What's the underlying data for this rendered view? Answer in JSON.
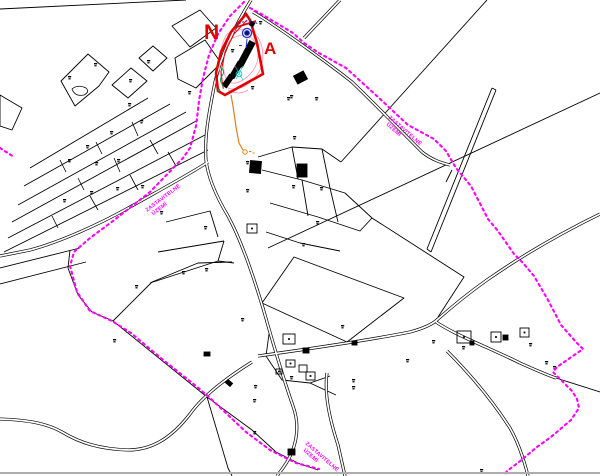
{
  "map": {
    "north_label": "N",
    "area_label": "A",
    "boundary_label": {
      "line1": "ZASTAVITELNÉ",
      "line2": "ÚZEMÍ"
    },
    "colors": {
      "boundary": "#ff00ff",
      "site": "#e30000",
      "contour": "#ff8fb0",
      "utility": "#e07f1a",
      "water": "#2136c9",
      "line": "#000000",
      "frame": "#adadad"
    },
    "parcel_marks": [
      [
        68,
        76
      ],
      [
        94,
        63
      ],
      [
        129,
        79
      ],
      [
        147,
        60
      ],
      [
        188,
        91
      ],
      [
        128,
        103
      ],
      [
        140,
        120
      ],
      [
        110,
        131
      ],
      [
        86,
        145
      ],
      [
        117,
        159
      ],
      [
        95,
        162
      ],
      [
        68,
        159
      ],
      [
        141,
        185
      ],
      [
        116,
        187
      ],
      [
        90,
        191
      ],
      [
        63,
        199
      ],
      [
        160,
        211
      ],
      [
        135,
        285
      ],
      [
        182,
        271
      ],
      [
        205,
        268
      ],
      [
        246,
        189
      ],
      [
        292,
        185
      ],
      [
        293,
        136
      ],
      [
        290,
        95
      ],
      [
        320,
        187
      ],
      [
        246,
        161
      ],
      [
        204,
        226
      ],
      [
        241,
        318
      ],
      [
        254,
        385
      ],
      [
        290,
        376
      ],
      [
        352,
        386
      ],
      [
        406,
        359
      ],
      [
        480,
        469
      ],
      [
        341,
        325
      ],
      [
        545,
        361
      ],
      [
        253,
        431
      ],
      [
        432,
        340
      ],
      [
        462,
        346
      ],
      [
        529,
        343
      ],
      [
        553,
        366
      ],
      [
        113,
        339
      ],
      [
        253,
        399
      ],
      [
        352,
        379
      ],
      [
        302,
        243
      ],
      [
        316,
        221
      ],
      [
        259,
        21
      ],
      [
        287,
        97
      ],
      [
        315,
        97
      ],
      [
        251,
        86
      ],
      [
        231,
        49
      ]
    ],
    "buildings": [
      {
        "x": 283,
        "y": 334,
        "w": 12,
        "h": 10,
        "filled": false,
        "dot": true,
        "angle": 0
      },
      {
        "x": 303,
        "y": 348,
        "w": 6,
        "h": 5,
        "filled": true,
        "dot": false,
        "angle": 0
      },
      {
        "x": 286,
        "y": 360,
        "w": 9,
        "h": 7,
        "filled": false,
        "dot": true,
        "angle": 0
      },
      {
        "x": 299,
        "y": 365,
        "w": 8,
        "h": 7,
        "filled": false,
        "dot": false,
        "angle": 0
      },
      {
        "x": 276,
        "y": 369,
        "w": 6,
        "h": 5,
        "filled": false,
        "dot": true,
        "angle": 0
      },
      {
        "x": 306,
        "y": 372,
        "w": 9,
        "h": 8,
        "filled": false,
        "dot": true,
        "angle": 0
      },
      {
        "x": 457,
        "y": 331,
        "w": 14,
        "h": 12,
        "filled": false,
        "dot": true,
        "angle": 0
      },
      {
        "x": 491,
        "y": 332,
        "w": 10,
        "h": 10,
        "filled": false,
        "dot": true,
        "angle": 0
      },
      {
        "x": 503,
        "y": 335,
        "w": 5,
        "h": 5,
        "filled": true,
        "dot": false,
        "angle": 0
      },
      {
        "x": 520,
        "y": 328,
        "w": 9,
        "h": 9,
        "filled": false,
        "dot": true,
        "angle": 0
      },
      {
        "x": 470,
        "y": 341,
        "w": 4,
        "h": 4,
        "filled": true,
        "dot": false,
        "angle": 0
      },
      {
        "x": 204,
        "y": 352,
        "w": 6,
        "h": 4,
        "filled": true,
        "dot": false,
        "angle": 0
      },
      {
        "x": 226,
        "y": 381,
        "w": 6,
        "h": 4,
        "filled": true,
        "dot": false,
        "angle": 40
      },
      {
        "x": 295,
        "y": 73,
        "w": 11,
        "h": 9,
        "filled": true,
        "dot": false,
        "angle": -28
      },
      {
        "x": 250,
        "y": 161,
        "w": 11,
        "h": 12,
        "filled": true,
        "dot": false,
        "angle": 5
      },
      {
        "x": 297,
        "y": 164,
        "w": 10,
        "h": 13,
        "filled": true,
        "dot": false,
        "angle": 0
      },
      {
        "x": 247,
        "y": 224,
        "w": 10,
        "h": 9,
        "filled": false,
        "dot": true,
        "angle": 0
      },
      {
        "x": 288,
        "y": 449,
        "w": 7,
        "h": 6,
        "filled": true,
        "dot": false,
        "angle": 0
      },
      {
        "x": 352,
        "y": 341,
        "w": 5,
        "h": 4,
        "filled": true,
        "dot": false,
        "angle": 0
      }
    ]
  }
}
